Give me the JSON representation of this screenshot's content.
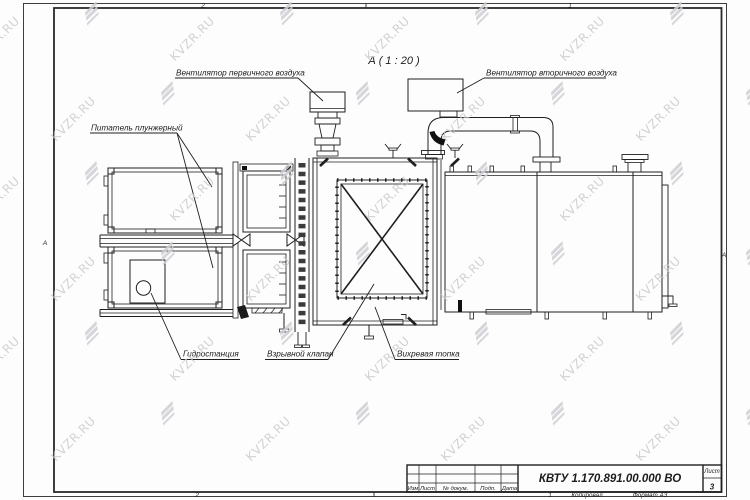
{
  "watermark": {
    "text": "KVZR.RU"
  },
  "view": {
    "title": "А ( 1 : 20 )"
  },
  "callouts": {
    "primary_fan": "Вентилятор первичного воздуха",
    "secondary_fan": "Вентилятор вторичного воздуха",
    "feeder": "Питатель плунжерный",
    "hydraulic": "Гидростанция",
    "explosion_valve": "Взрывной клапан",
    "furnace": "Вихревая топка"
  },
  "zones": {
    "top_left": "2",
    "top_right": "1",
    "bottom_left": "2",
    "bottom_right": "1",
    "side_left": "А",
    "side_right": "А"
  },
  "title_block": {
    "headers": {
      "izm": "Изм",
      "list": "Лист",
      "doc": "№ докум.",
      "podp": "Подп.",
      "data": "Дата"
    },
    "doc_number": "КВТУ 1.170.891.00.000 ВО",
    "sheet_label": "Лист",
    "sheet_number": "3",
    "footer": {
      "copied": "Копировал",
      "format": "Формат А3"
    }
  },
  "colors": {
    "line": "#1f1f1f",
    "watermark": "#c7c7cd"
  }
}
